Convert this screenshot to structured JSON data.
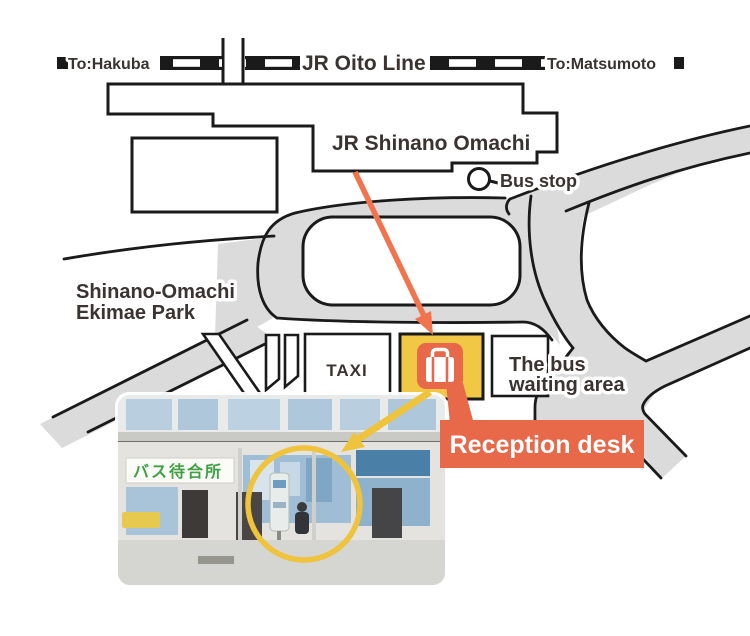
{
  "railway": {
    "left_destination": "To:Hakuba",
    "line_name": "JR Oito Line",
    "right_destination": "To:Matsumoto"
  },
  "station_label": "JR Shinano Omachi",
  "bus_stop_label": "Bus stop",
  "park_label": {
    "line1": "Shinano-Omachi",
    "line2": "Ekimae Park"
  },
  "taxi_label": "TAXI",
  "bus_waiting_label": {
    "line1": "The bus",
    "line2": "waiting area"
  },
  "reception_label": "Reception desk",
  "photo_sign": "バス待合所",
  "icons": {
    "luggage": "luggage-icon",
    "bus_stop_marker": "bus-stop-circle-icon"
  },
  "colors": {
    "road_gray": "#DBDBDB",
    "line_black": "#1A1A1A",
    "accent_coral": "#E8694A",
    "arrow_orange": "#F2744E",
    "accent_yellow": "#EFC33C",
    "box_yellow": "#F0C845",
    "text_dark": "#3B3330",
    "photo_sign_green": "#3FA044"
  }
}
